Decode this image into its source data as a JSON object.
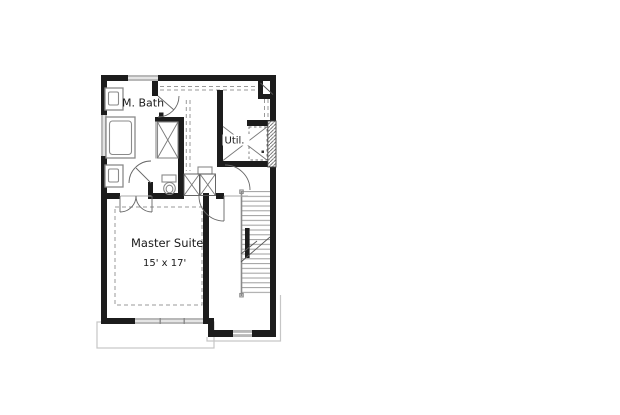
{
  "plan": {
    "rooms": {
      "master_bath": {
        "label": "M. Bath"
      },
      "utility": {
        "label": "Util."
      },
      "master_suite": {
        "label": "Master Suite",
        "dimensions": "15' x 17'"
      }
    }
  },
  "colors": {
    "background": "#ffffff",
    "wall": "#1c1c1c",
    "window": "#b8b8b8",
    "fixture": "#8a8a8a",
    "door": "#666666",
    "dash": "#999999",
    "tread": "#9a9a9a",
    "roof": "#c6c6c6",
    "text": "#1a1a1a"
  }
}
